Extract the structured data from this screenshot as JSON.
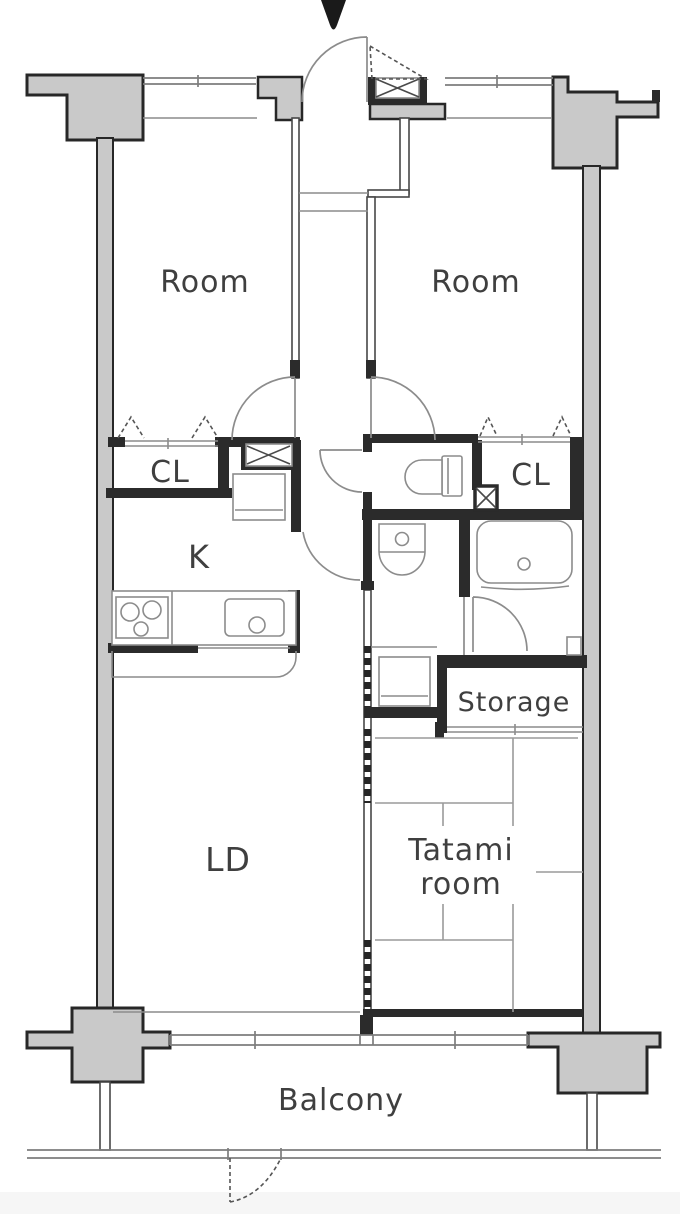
{
  "plan": {
    "type": "apartment-floor-plan",
    "labels": {
      "room_left": "Room",
      "room_right": "Room",
      "closet_left": "CL",
      "closet_right": "CL",
      "kitchen": "K",
      "living_dining": "LD",
      "tatami_line1": "Tatami",
      "tatami_line2": "room",
      "storage": "Storage",
      "balcony": "Balcony"
    },
    "icons": {
      "entrance_arrow": "black downward arrow marking the entrance door"
    },
    "colors": {
      "structure_fill": "#c9c9c9",
      "structure_stroke": "#272727",
      "wall": "#2b2b2b",
      "line": "#8c8c8c",
      "text": "#3f3f3f",
      "background": "#ffffff"
    }
  }
}
